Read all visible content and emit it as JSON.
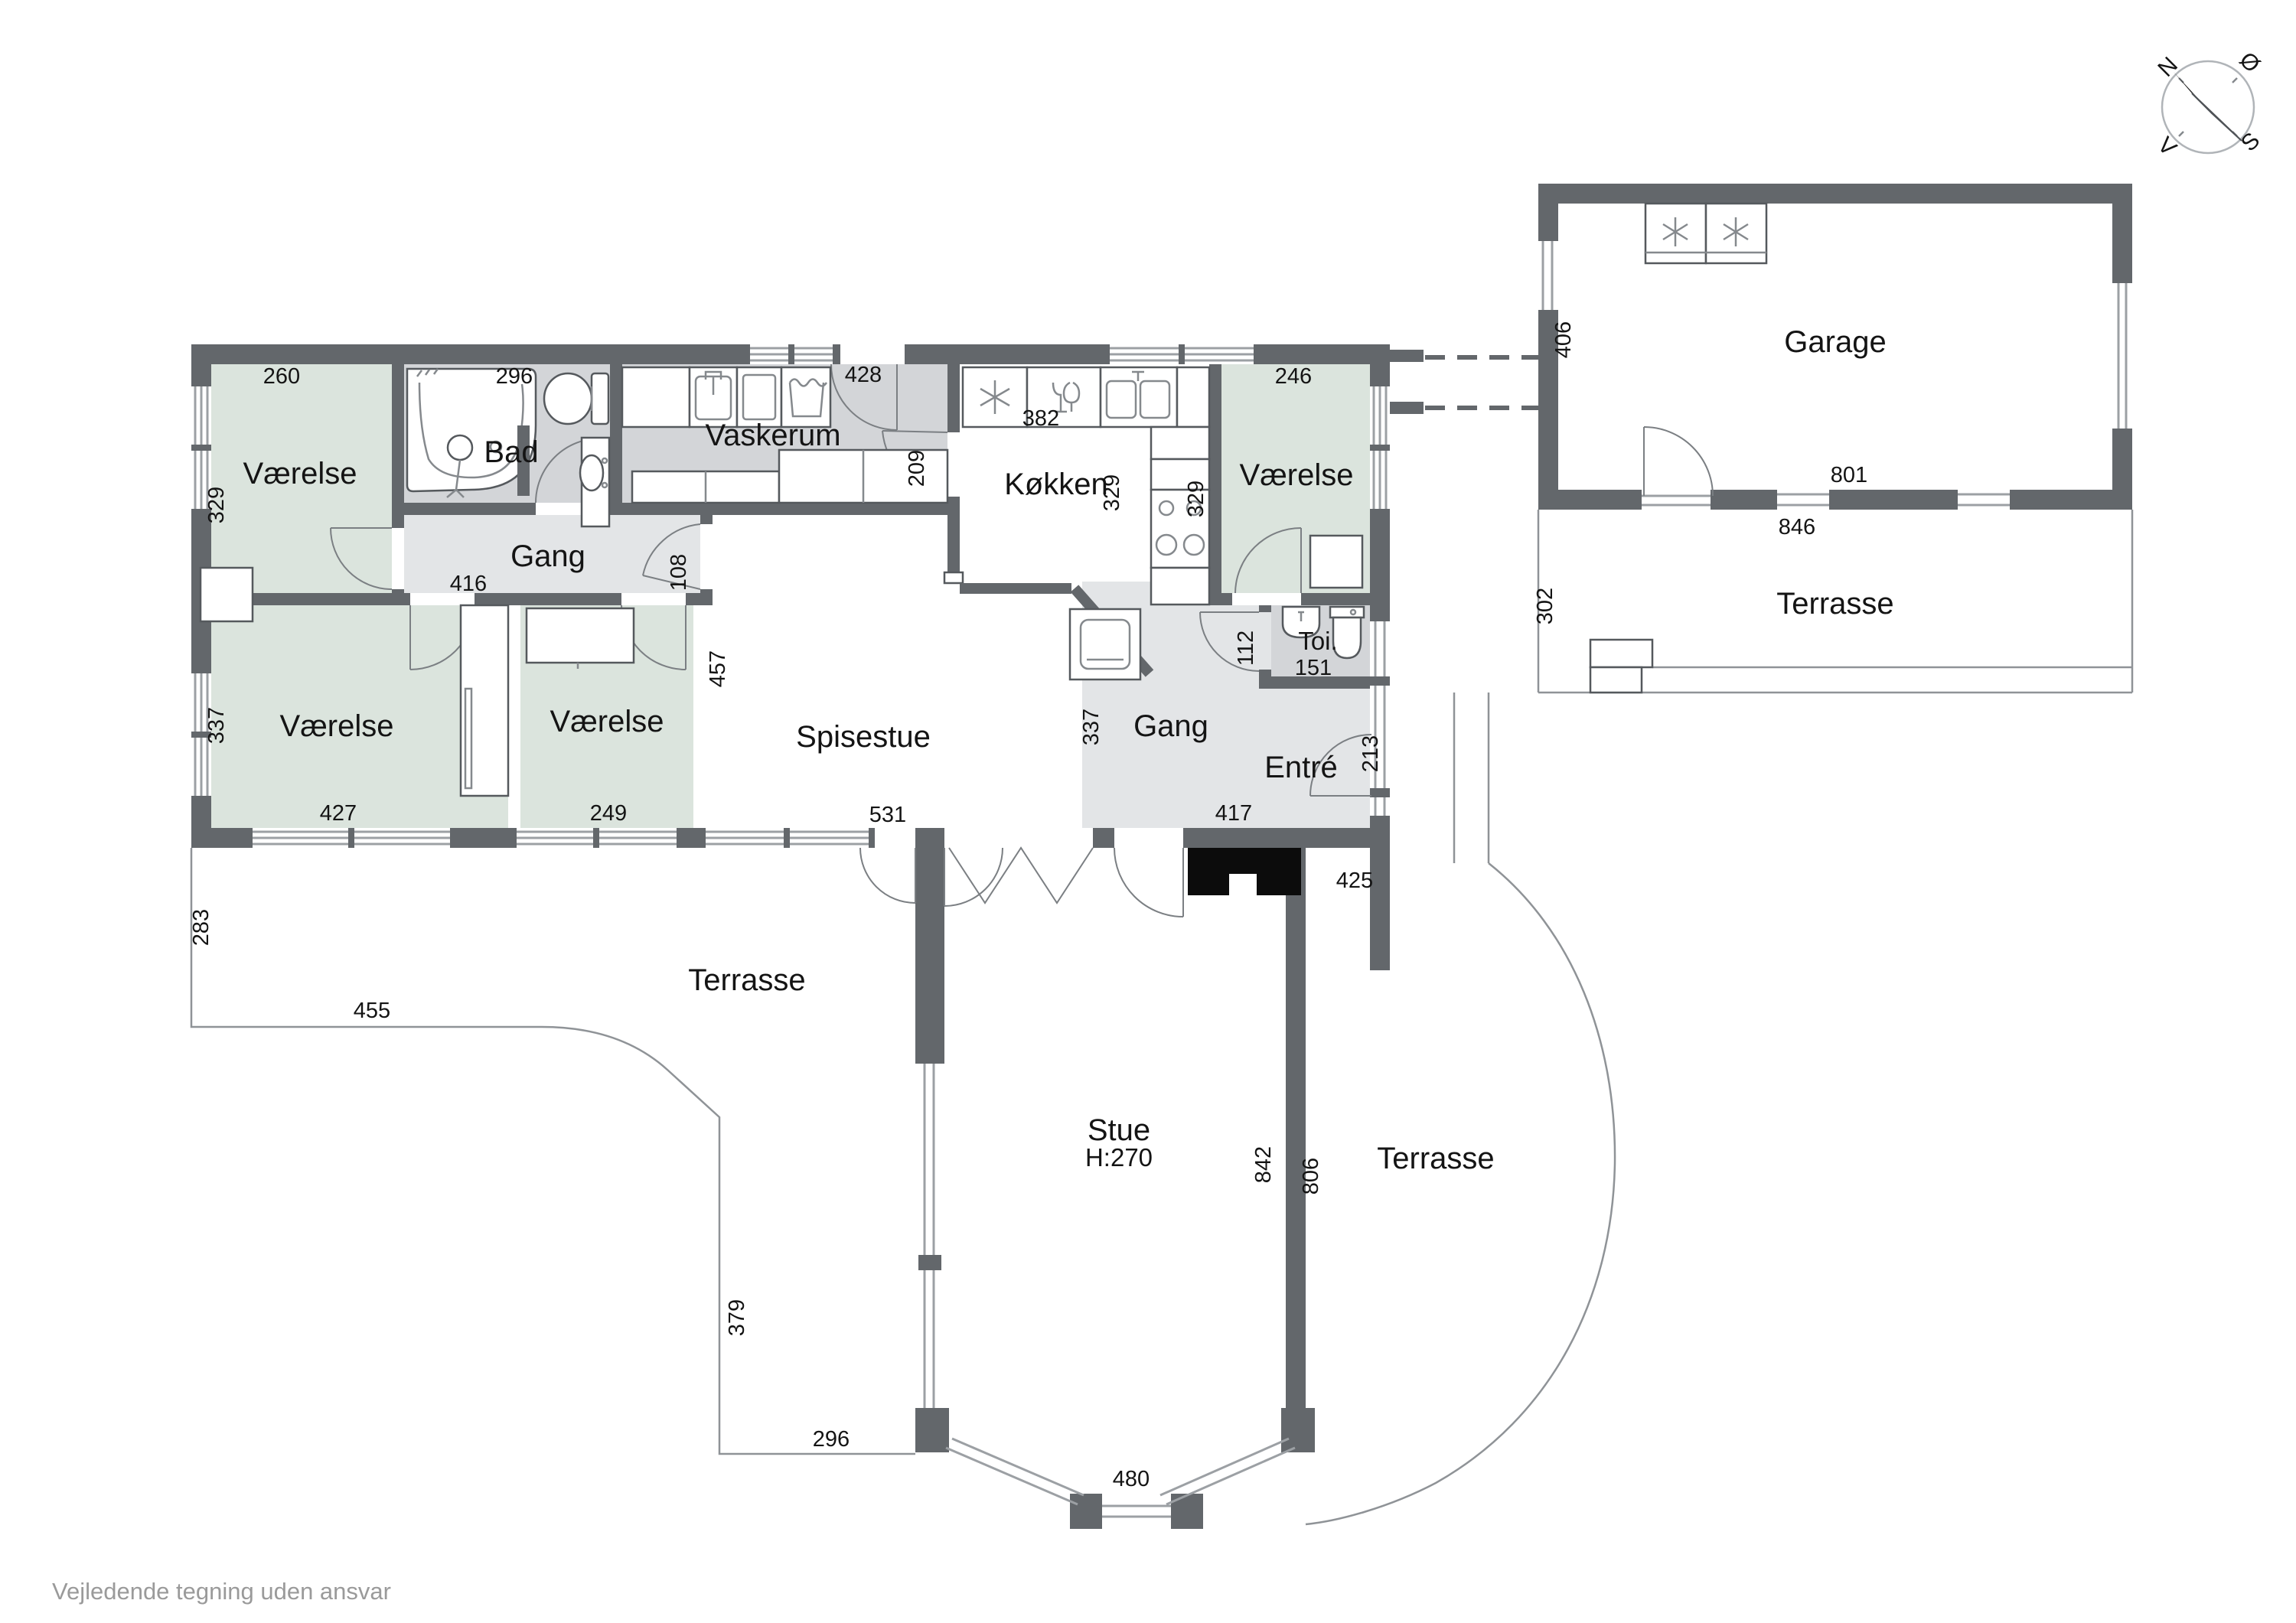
{
  "disclaimer": "Vejledende tegning uden ansvar",
  "compass": {
    "north": "N",
    "east": "Ø",
    "south": "S",
    "west": "V"
  },
  "rooms": {
    "vaerelse_tl": {
      "label": "Værelse",
      "width_cm": "260",
      "height_cm": "329"
    },
    "bad": {
      "label": "Bad",
      "width_cm": "296"
    },
    "vaskerum": {
      "label": "Vaskerum",
      "door_cm": "428",
      "opening_cm": "209"
    },
    "koekken": {
      "label": "Køkken",
      "width_cm": "382",
      "height_cm": "329"
    },
    "vaerelse_tr": {
      "label": "Værelse",
      "width_cm": "246",
      "height_cm": "329"
    },
    "gang_top": {
      "label": "Gang",
      "width_cm": "416",
      "door_cm": "108"
    },
    "vaerelse_bl": {
      "label": "Værelse",
      "width_cm": "427",
      "height_cm": "337"
    },
    "vaerelse_bm": {
      "label": "Værelse",
      "width_cm": "249"
    },
    "spisestue": {
      "label": "Spisestue",
      "width_cm": "531",
      "height_cm": "457"
    },
    "gang_right": {
      "label": "Gang",
      "width_cm": "417",
      "height_cm": "337"
    },
    "entre": {
      "label": "Entré",
      "door_cm": "213"
    },
    "toilet": {
      "label": "Toi.",
      "width_cm": "151",
      "height_cm": "112"
    },
    "stue": {
      "label": "Stue",
      "ceiling": "H:270",
      "height_cm": "842",
      "bay_cm": "480"
    },
    "garage": {
      "label": "Garage",
      "width_cm": "801",
      "height_cm": "406",
      "south_cm": "846"
    }
  },
  "terraces": {
    "left": {
      "label": "Terrasse",
      "height_cm": "283",
      "width_cm": "455",
      "edge_cm": "379",
      "south_cm": "296"
    },
    "south": {
      "label": "Terrasse",
      "height_cm": "806",
      "west_cm": "425"
    },
    "garage": {
      "label": "Terrasse",
      "height_cm": "302"
    }
  }
}
